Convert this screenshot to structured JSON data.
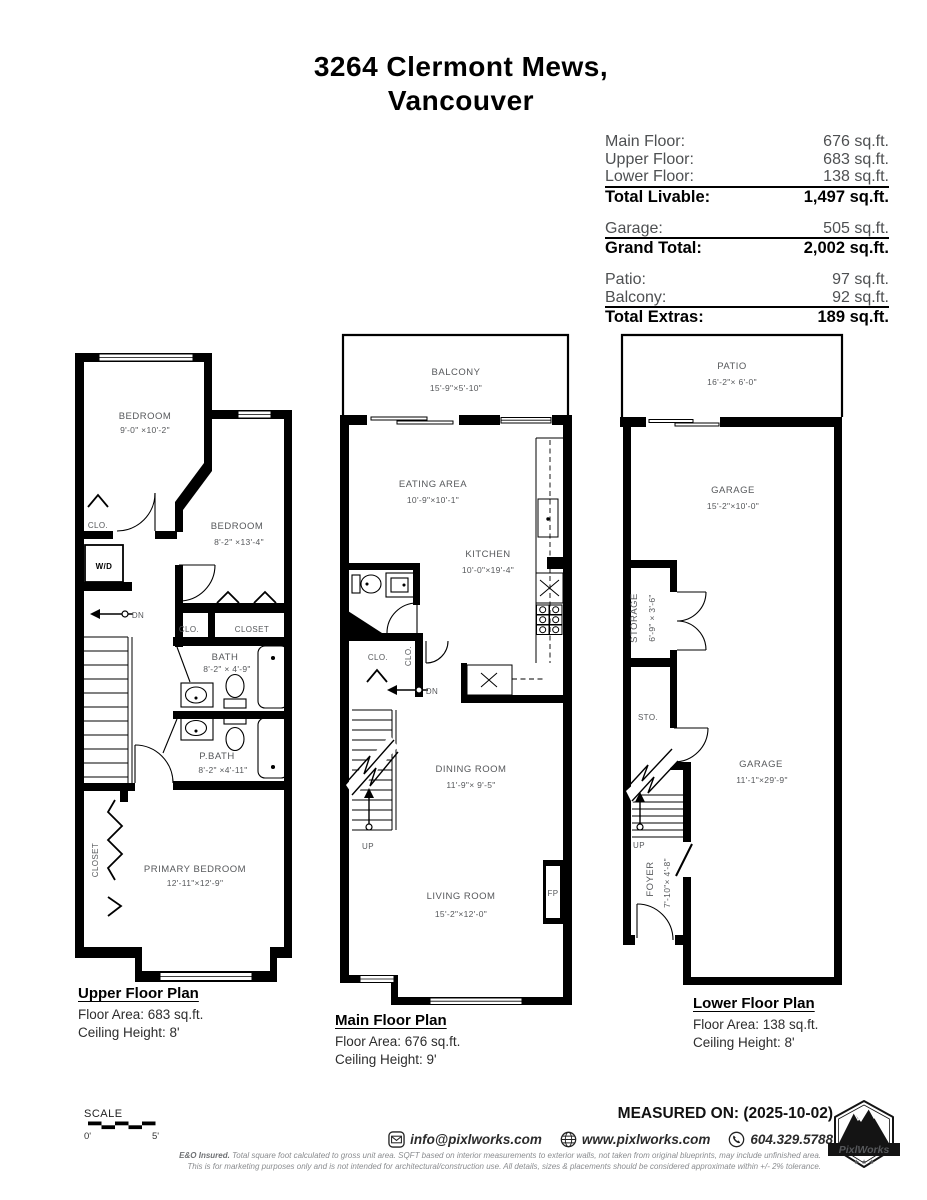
{
  "title": {
    "line1": "3264 Clermont Mews,",
    "line2": "Vancouver"
  },
  "summary": {
    "groups": [
      {
        "rows": [
          {
            "label": "Main Floor:",
            "value": "676 sq.ft."
          },
          {
            "label": "Upper Floor:",
            "value": "683 sq.ft."
          },
          {
            "label": "Lower Floor:",
            "value": "138 sq.ft."
          }
        ],
        "total": {
          "label": "Total Livable:",
          "value": "1,497 sq.ft."
        }
      },
      {
        "rows": [
          {
            "label": "Garage:",
            "value": "505 sq.ft."
          }
        ],
        "total": {
          "label": "Grand Total:",
          "value": "2,002 sq.ft."
        }
      },
      {
        "rows": [
          {
            "label": "Patio:",
            "value": "97 sq.ft."
          },
          {
            "label": "Balcony:",
            "value": "92 sq.ft."
          }
        ],
        "total": {
          "label": "Total Extras:",
          "value": "189 sq.ft."
        }
      }
    ]
  },
  "plans": {
    "upper": {
      "caption": {
        "title": "Upper Floor Plan",
        "area": "Floor Area: 683 sq.ft.",
        "ceiling": "Ceiling Height: 8'"
      },
      "labels": {
        "bedroom1": {
          "name": "BEDROOM",
          "dims": "9'-0\" ×10'-2\""
        },
        "bedroom2": {
          "name": "BEDROOM",
          "dims": "8'-2\" ×13'-4\""
        },
        "bath": {
          "name": "BATH",
          "dims": "8'-2\" × 4'-9\""
        },
        "pbath": {
          "name": "P.BATH",
          "dims": "8'-2\" ×4'-11\""
        },
        "primary": {
          "name": "PRIMARY BEDROOM",
          "dims": "12'-11\"×12'-9\""
        },
        "clo1": "CLO.",
        "clo2": "CLO.",
        "closet": "CLOSET",
        "closet_v": "CLOSET",
        "wd": "W/D",
        "dn": "DN"
      }
    },
    "main": {
      "caption": {
        "title": "Main Floor Plan",
        "area": "Floor Area: 676 sq.ft.",
        "ceiling": "Ceiling Height: 9'"
      },
      "labels": {
        "balcony": {
          "name": "BALCONY",
          "dims": "15'-9\"×5'-10\""
        },
        "eating": {
          "name": "EATING AREA",
          "dims": "10'-9\"×10'-1\""
        },
        "kitchen": {
          "name": "KITCHEN",
          "dims": "10'-0\"×19'-4\""
        },
        "dining": {
          "name": "DINING ROOM",
          "dims": "11'-9\"× 9'-5\""
        },
        "living": {
          "name": "LIVING ROOM",
          "dims": "15'-2\"×12'-0\""
        },
        "clo1": "CLO.",
        "clo2": "CLO.",
        "dn": "DN",
        "up": "UP",
        "fp": "FP"
      }
    },
    "lower": {
      "caption": {
        "title": "Lower Floor Plan",
        "area": "Floor Area: 138 sq.ft.",
        "ceiling": "Ceiling Height: 8'"
      },
      "labels": {
        "patio": {
          "name": "PATIO",
          "dims": "16'-2\"× 6'-0\""
        },
        "garage1": {
          "name": "GARAGE",
          "dims": "15'-2\"×10'-0\""
        },
        "garage2": {
          "name": "GARAGE",
          "dims": "11'-1\"×29'-9\""
        },
        "storage": {
          "name": "STORAGE",
          "dims": "6'-9\" × 3'-6\""
        },
        "foyer": {
          "name": "FOYER",
          "dims": "7'-10\"× 4'-8\""
        },
        "sto": "STO.",
        "up": "UP"
      }
    }
  },
  "footer": {
    "scale": {
      "label": "SCALE",
      "start": "0'",
      "end": "5'"
    },
    "measured": "MEASURED ON: (2025-10-02)",
    "contact": {
      "email": "info@pixlworks.com",
      "website": "www.pixlworks.com",
      "phone": "604.329.5788"
    },
    "disclaimer1_bold": "E&O Insured.",
    "disclaimer1": "Total square foot calculated to gross unit area. SQFT based on interior measurements to exterior walls, not taken from original blueprints, may include unfinished area.",
    "disclaimer2": "This is for marketing purposes only and is not intended for architectural/construction use.  All details, sizes & placements should be considered approximate within +/- 2%  tolerance.",
    "logo": {
      "name": "PixlWorks",
      "stars": "★ ★ ★"
    }
  },
  "colors": {
    "wall": "#000000",
    "label_gray": "#56585b",
    "disclaimer_gray": "#8a8c8f"
  }
}
